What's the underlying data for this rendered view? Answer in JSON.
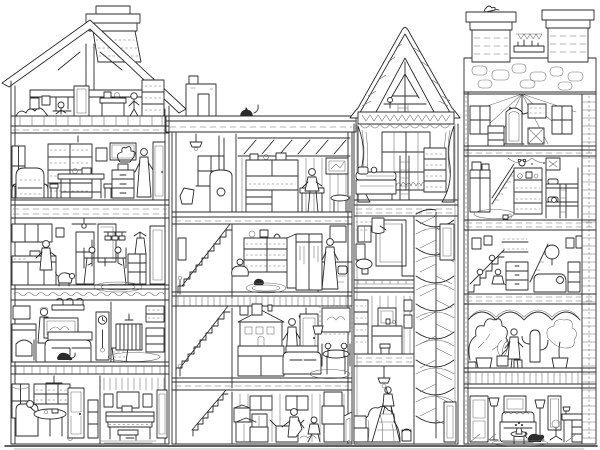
{
  "meta": {
    "title": "Cutaway dollhouse illustration: four adjoining houses drawn in black ink with every room, staircase and resident visible",
    "medium": "hand-drawn pen and ink line art",
    "palette": {
      "ink": "#2b2b2b",
      "paper": "#ffffff",
      "texture": "#6a6a6a"
    }
  },
  "scene": {
    "ground": {
      "label": "street ground line"
    },
    "buildings": [
      {
        "name": "gabled-townhouse",
        "label": "Left gabled townhouse with tall brick chimney",
        "rooms": [
          {
            "label": "Attic workshop under roof beams with swing, desk and shelf"
          },
          {
            "label": "Library study with bookcases, desk, armchair and standing reader"
          },
          {
            "label": "Kitchen and dining room with cook, dog, refrigerator and family at table"
          },
          {
            "label": "Living room with sofa, cat, grandfather clock, fireplace and nursery crib"
          },
          {
            "label": "Ground-floor parlor with round table and hallway with upright piano"
          }
        ]
      },
      {
        "name": "flat-roof-studio-house",
        "label": "Flat-roofed house with rooftop cat and skylit studio",
        "rooms": [
          {
            "label": "Skylit artist studio with cabinets and workbench, plus stove room"
          },
          {
            "label": "Bedroom with bookcase, wardrobe, dressing figure and bed"
          },
          {
            "label": "Sitting room with dollhouse on sideboard, sofa and children at table"
          },
          {
            "label": "Storage room full of moving boxes with two figures unpacking"
          },
          {
            "label": "Stairwell with three flights of stairs"
          }
        ]
      },
      {
        "name": "steep-roof-tower",
        "label": "Tower with steep thatched roof and spiral staircase shaft",
        "rooms": [
          {
            "label": "Timber-framed roof loft"
          },
          {
            "label": "Curtained bedroom with large window, bed and ladder"
          },
          {
            "label": "Bathroom with shower stall and toilet"
          },
          {
            "label": "Dressing room with vanity mirror and shelf"
          },
          {
            "label": "Room under renovation: figure on stepladder, dust-sheeted furniture, paint bucket"
          },
          {
            "label": "Spiral staircase shaft with doors"
          }
        ]
      },
      {
        "name": "stone-house",
        "label": "Right stone house with twin chimney stacks and quoined edge",
        "rooms": [
          {
            "label": "Tented attic with chandelier, arched mirror and bookshelf"
          },
          {
            "label": "Children's room with bunk bed, toy shelf, wardrobe and garland"
          },
          {
            "label": "Bedroom hall with staircases, dresser, round mirror and chaise"
          },
          {
            "label": "Conservatory filled with plants and a gardener"
          },
          {
            "label": "Parlor with sofa, twin lamps, writing desk and dog"
          }
        ]
      }
    ],
    "creatures": [
      {
        "name": "cat-on-roof",
        "label": "cat sitting on the flat roof"
      },
      {
        "name": "kitchen-dog",
        "label": "dog in the kitchen"
      },
      {
        "name": "living-room-cat",
        "label": "cat by the sofa"
      },
      {
        "name": "bedroom-cat",
        "label": "cat in the bedroom"
      },
      {
        "name": "chimney-bird",
        "label": "bird on the chimney cap"
      },
      {
        "name": "parlor-dog",
        "label": "dog in the stone-house parlor"
      }
    ]
  }
}
